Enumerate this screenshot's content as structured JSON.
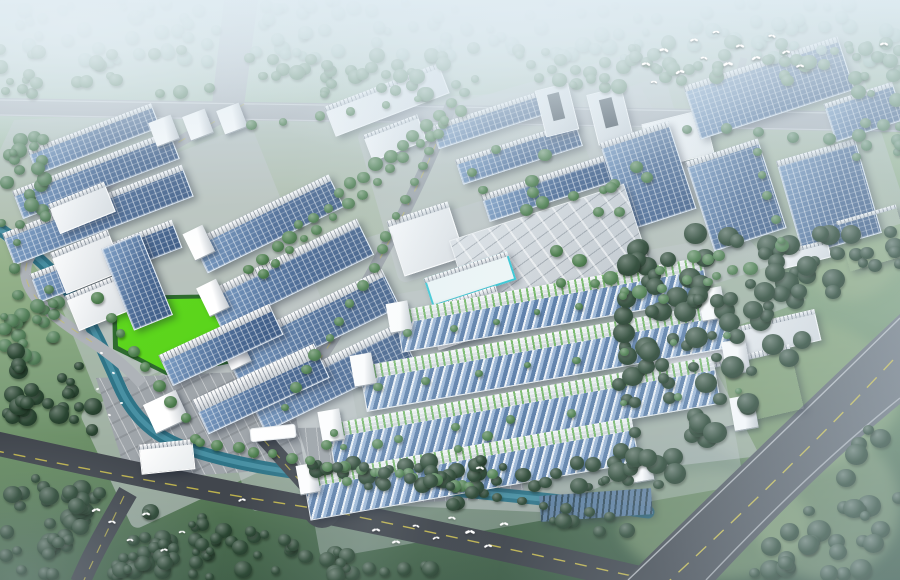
{
  "scene": {
    "type": "aerial-architectural-rendering",
    "description": "Bird's-eye 3D rendering of an eco industrial park: rows of white factory and dormitory buildings with rooftop photovoltaic solar panels, a central utility plant, tree-lined internal avenues, a winding teal canal, a bright green sports field, striped parking lots, a dark asphalt road intersection with flocks of white birds, a wide diagonal highway through forest at lower right, all surrounded by misty green woodland",
    "visible_text": "",
    "elements": [
      "solar-roof-warehouses",
      "sawtooth-roof-factories",
      "white-office-towers",
      "utility-plant",
      "cyan-glass-building",
      "entrance-gate",
      "gatehouse",
      "sports-field",
      "canal",
      "parking-lots",
      "tree-avenues",
      "forest",
      "asphalt-intersection",
      "diagonal-highway",
      "ground-solar-array",
      "birds",
      "fog-haze"
    ],
    "palette": {
      "hazeA": "#dfecf3",
      "hazeB": "#cfe0e8",
      "mist": "#8fb3a0",
      "forestMid": "#54805a",
      "forestDark": "#2a4632",
      "campTree": "#4e7f4f",
      "grass": "#9cb586",
      "roadLight": "#aeb3b8",
      "roadDark": "#41464d",
      "roadEdge": "#d8dcdf",
      "laneYellow": "#d2c44e",
      "pavement": "#c3c8cc",
      "parking": "#9fa5aa",
      "solarHi": "#7fa0c6",
      "solarMid": "#4d6c96",
      "solarLo": "#3c5a84",
      "sawLight": "#eef3f8",
      "sawMid": "#9fb9d8",
      "sawDark": "#5e80aa",
      "buildingWhite": "#f7f9fa",
      "buildingShade": "#c6ccd2",
      "facadeGreen": "#6eb45f",
      "water": "#2f7487",
      "waterLight": "#5fa8ba",
      "fieldGreen": "#55d315",
      "cyan": "#3bc7d4",
      "birdWhite": "#ffffff"
    },
    "counts": {
      "building_blocks": 58,
      "bird_flock_top": 14,
      "bird_flock_bottom": 16,
      "boats_on_canal": 5
    }
  }
}
